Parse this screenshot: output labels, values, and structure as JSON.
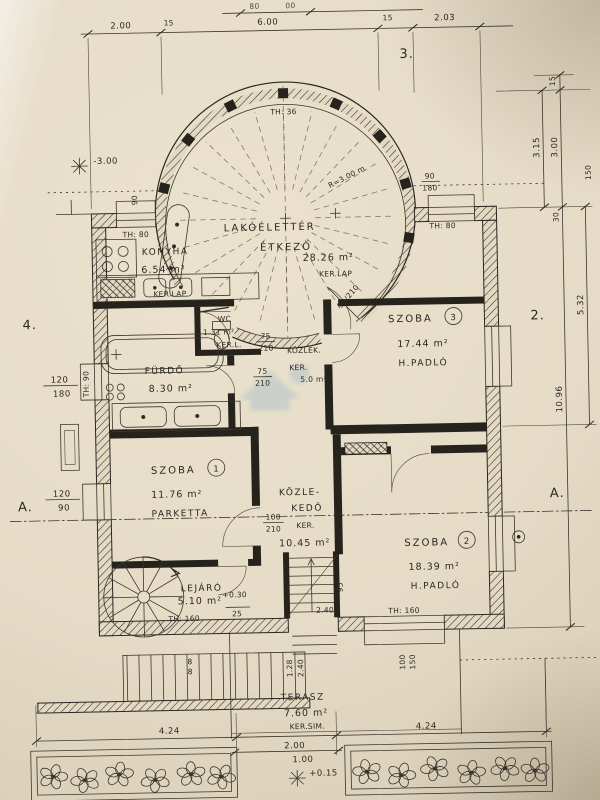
{
  "sheet": {
    "top_label": "3.",
    "left_label": "4.",
    "right_label": "2.",
    "section_left": "A.",
    "section_right": "A.",
    "level_basement": "-3.00",
    "level_terrace": "+0.15"
  },
  "dims_top": {
    "left": "2.00",
    "wall_left": "15",
    "middle": "6.00",
    "wall_right": "15",
    "right": "2.03",
    "edge_a": "80",
    "edge_b": "00"
  },
  "dims_right": {
    "t15": "15",
    "v3_15": "3.15",
    "v3_00": "3.00",
    "v30": "30",
    "v150": "150",
    "v5_32": "5.32",
    "v10_96": "10.96"
  },
  "dims_left": {
    "win1_w": "120",
    "win1_h": "180",
    "win2_w": "120",
    "win2_h": "90",
    "th_bath": "TH: 90",
    "door_w": "90"
  },
  "dims_bottom": {
    "left": "4.24",
    "center": "2.00",
    "center_small": "1.00",
    "right": "4.24",
    "stair_w": "1.28",
    "stair_l": "2.40",
    "riser_a": "8",
    "riser_b": "8",
    "win_w": "100",
    "win_h": "150"
  },
  "rooms": {
    "living": {
      "name_line1": "LAKÓÉLETTÉR",
      "name_line2": "ÉTKEZŐ",
      "area": "28.26 m²",
      "floor": "KER.LAP",
      "radius": "R=3.00 m",
      "parapet": "TH: 36",
      "door": "90/210",
      "win_w": "90",
      "win_h": "180",
      "parapet_right": "TH: 80"
    },
    "kitchen": {
      "name": "KONYHA",
      "area": "6.54 m²",
      "floor": "KER.LAP",
      "parapet": "TH: 80"
    },
    "room3": {
      "name": "SZOBA",
      "number": "3",
      "area": "17.44 m²",
      "floor": "H.PADLÓ"
    },
    "bath": {
      "name": "FÜRDŐ",
      "area": "8.30 m²"
    },
    "wc": {
      "name": "WC",
      "area": "1.31 m²",
      "floor": "KER.L."
    },
    "hall_small": {
      "name": "KÖZLEK.",
      "floor": "KER.",
      "area": "5.0 m²",
      "door_w": "75",
      "door_h": "210"
    },
    "hall": {
      "name_line1": "KÖZLE-",
      "name_line2": "KEDŐ",
      "floor": "KER.",
      "area": "10.45 m²",
      "door_w": "100",
      "door_h": "210"
    },
    "room1": {
      "name": "SZOBA",
      "number": "1",
      "area": "11.76 m²",
      "floor": "PARKETTA"
    },
    "room2": {
      "name": "SZOBA",
      "number": "2",
      "area": "18.39 m²",
      "floor": "H.PADLÓ",
      "parapet": "TH: 160"
    },
    "stair": {
      "name": "LEJÁRÓ",
      "area": "5.10 m²",
      "parapet": "TH: 160",
      "level": "+0.30",
      "tread": "25",
      "width": "95",
      "length": "2.40"
    },
    "terrace": {
      "name": "TERASZ",
      "area": "7.60 m²",
      "floor": "KER.SIM."
    }
  }
}
